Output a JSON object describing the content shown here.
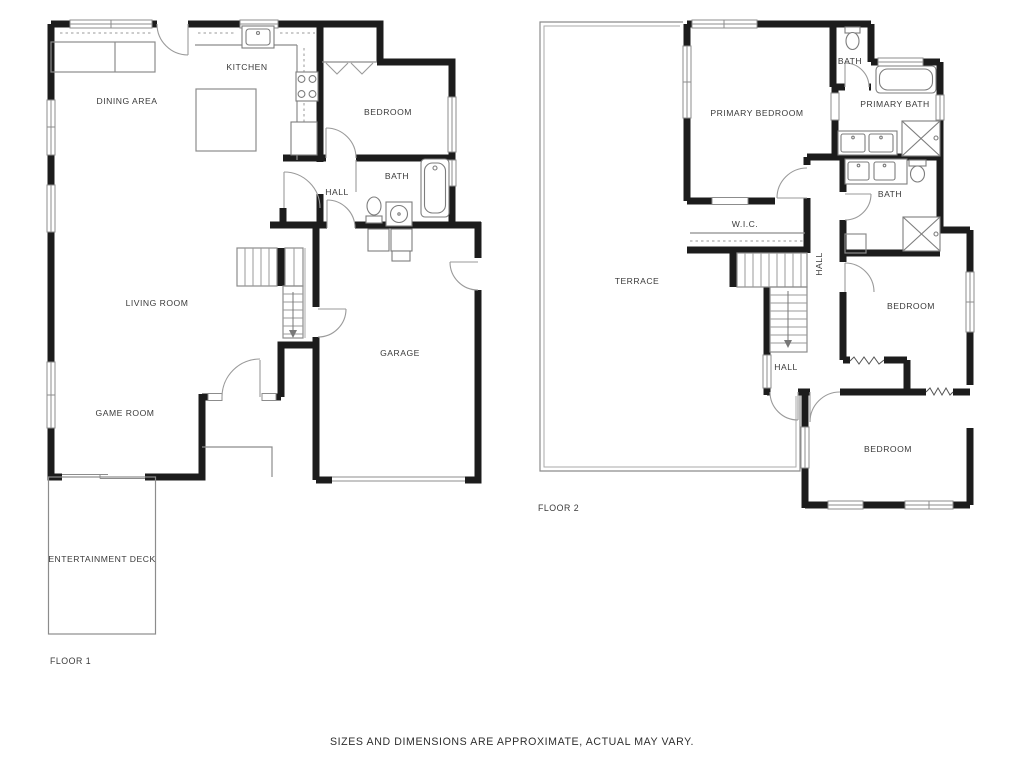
{
  "colors": {
    "background": "#ffffff",
    "wall": "#1c1c1c",
    "thin_line": "#8c8c8c",
    "text": "#3a3a3a"
  },
  "floor1": {
    "label": "FLOOR 1",
    "rooms": {
      "kitchen": "KITCHEN",
      "dining_area": "DINING AREA",
      "bedroom": "BEDROOM",
      "bath": "BATH",
      "hall": "HALL",
      "living_room": "LIVING ROOM",
      "garage": "GARAGE",
      "game_room": "GAME ROOM",
      "entertainment_deck": "ENTERTAINMENT DECK"
    }
  },
  "floor2": {
    "label": "FLOOR 2",
    "rooms": {
      "primary_bedroom": "PRIMARY BEDROOM",
      "bath_wc": "BATH",
      "primary_bath": "PRIMARY BATH",
      "bath": "BATH",
      "wic": "W.I.C.",
      "terrace": "TERRACE",
      "hall_upper": "HALL",
      "hall_lower": "HALL",
      "bedroom_middle": "BEDROOM",
      "bedroom_lower": "BEDROOM"
    }
  },
  "footer": {
    "disclaimer": "SIZES AND DIMENSIONS ARE APPROXIMATE, ACTUAL MAY VARY."
  }
}
